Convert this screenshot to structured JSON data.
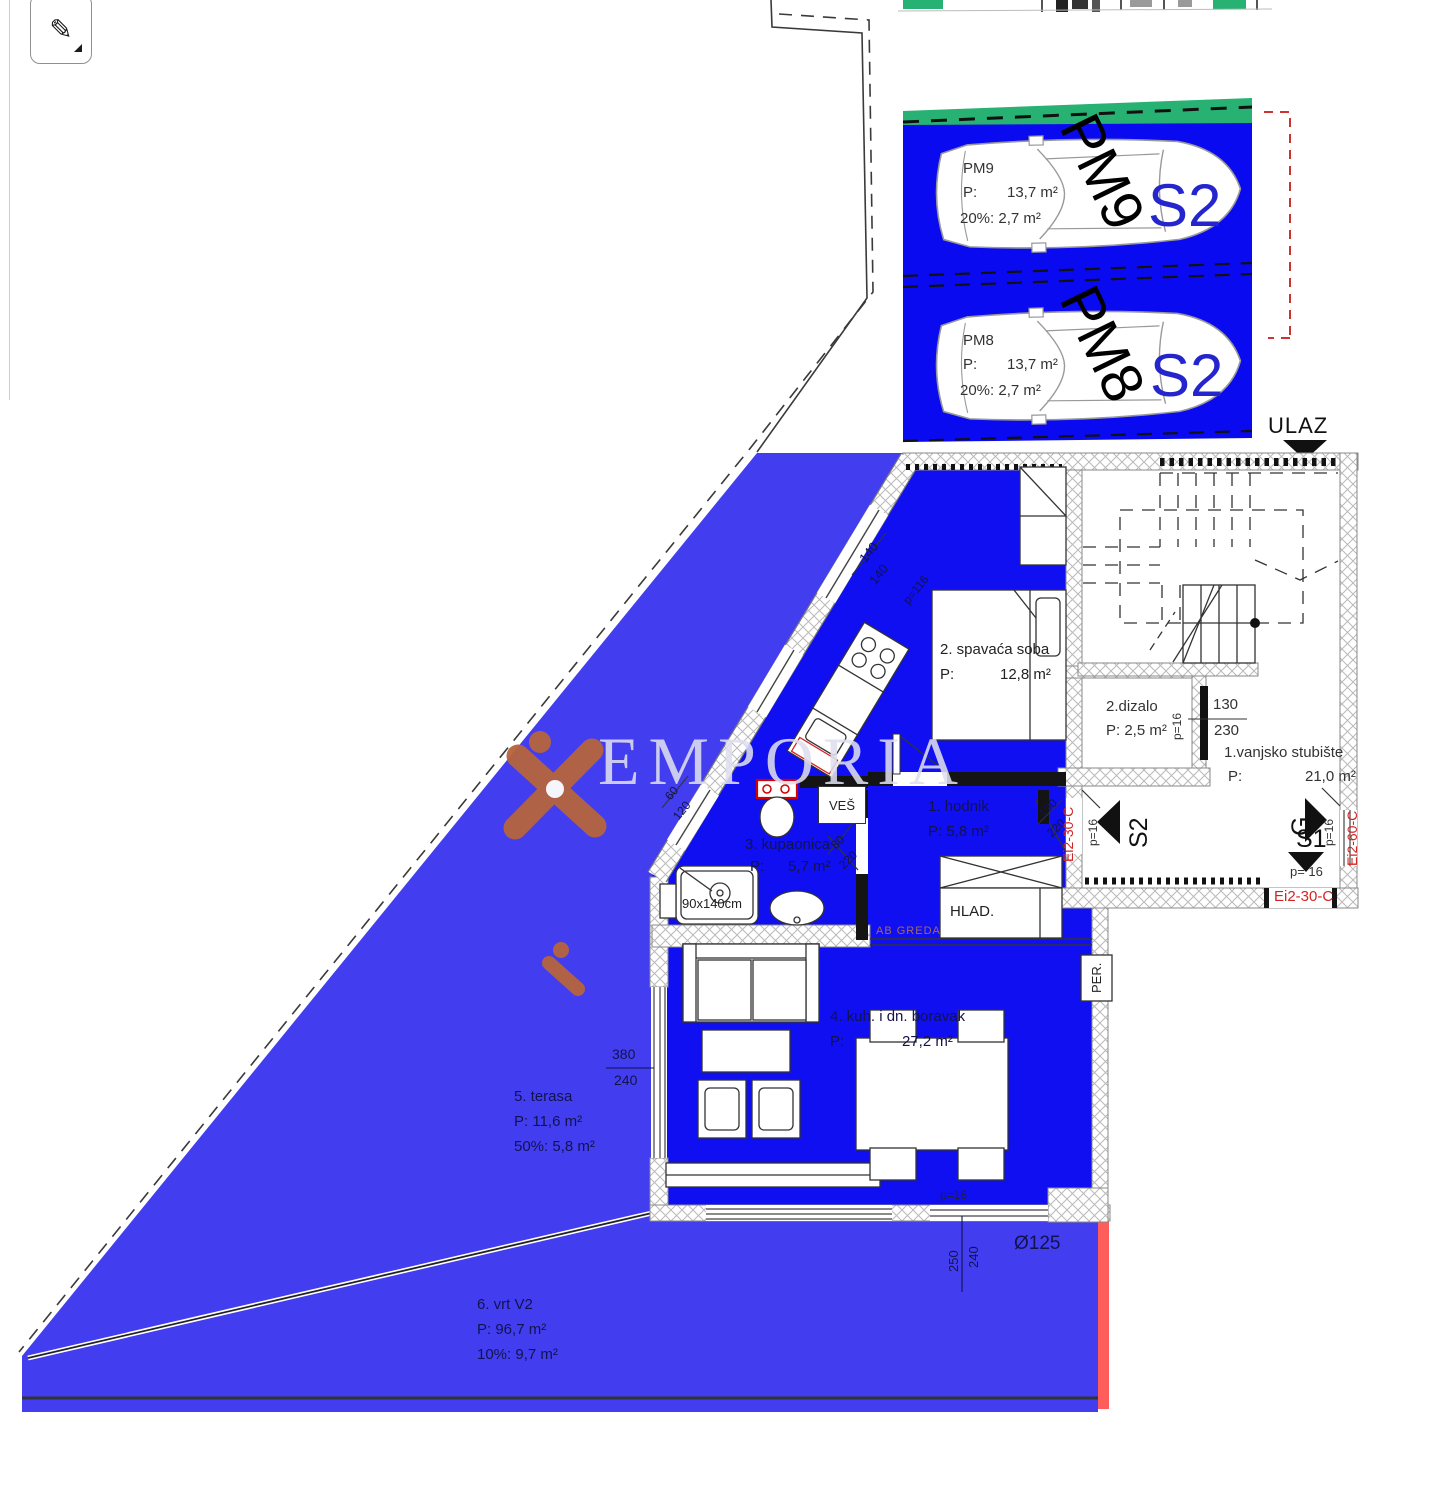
{
  "toolbar": {
    "pen_tool_glyph": "✎"
  },
  "watermark": {
    "brand": "EMPORIA"
  },
  "parking": {
    "stalls": [
      {
        "id": "PM9",
        "p_label": "P:",
        "area": "13,7 m²",
        "pct_line": "20%: 2,7 m²",
        "big_label": "PM9",
        "unit": "S2"
      },
      {
        "id": "PM8",
        "p_label": "P:",
        "area": "13,7 m²",
        "pct_line": "20%: 2,7 m²",
        "big_label": "PM8",
        "unit": "S2"
      }
    ]
  },
  "plan": {
    "entrance_label": "ULAZ",
    "common": {
      "stubiste_name": "1.vanjsko stubište",
      "stubiste_p": "P:",
      "stubiste_area": "21,0 m²",
      "dizalo_name": "2.dizalo",
      "dizalo_area": "P: 2,5 m²"
    },
    "rooms": {
      "spavaca_name": "2. spavaća soba",
      "spavaca_p": "P:",
      "spavaca_area": "12,8 m²",
      "hodnik_name": "1. hodnik",
      "hodnik_area": "P: 5,8 m²",
      "kupaonica_name": "3. kupaonica",
      "kupaonica_p": "P:",
      "kupaonica_area": "5,7 m²",
      "boravak_name": "4. kuh. i dn. boravak",
      "boravak_p": "P:",
      "boravak_area": "27,2 m²",
      "terasa_name": "5. terasa",
      "terasa_area": "P:    11,6 m²",
      "terasa_pct": "50%: 5,8 m²",
      "vrt_name": "6. vrt V2",
      "vrt_area": "P:    96,7 m²",
      "vrt_pct": "10%: 9,7 m²"
    },
    "fixtures": {
      "ves": "VEŠ",
      "hlad": "HLAD.",
      "per": "PER.",
      "shower": "90x140cm",
      "ab_greda": "AB GREDA"
    },
    "dims": {
      "d140a": "140",
      "d140b": "140",
      "p116": "p=116",
      "d60": "60",
      "d120": "120",
      "d80": "80",
      "d220a": "220",
      "d100": "100",
      "d220b": "220",
      "d130": "130",
      "d230": "230",
      "p16_dizalo": "p=16",
      "p16_left": "p=16",
      "p16_right": "p=16",
      "p16_bottom": "p= 16",
      "p16_wall": "p=16",
      "d380": "380",
      "d240": "240",
      "d250": "250",
      "d240b": "240",
      "fi125": "Ø125"
    },
    "fire": {
      "left": "Ei2-30-C",
      "right": "Ei2-60-C",
      "bottom": "Ei2-30-C"
    },
    "arrows": {
      "s2": "S2",
      "g": "G",
      "s1": "S1"
    }
  }
}
